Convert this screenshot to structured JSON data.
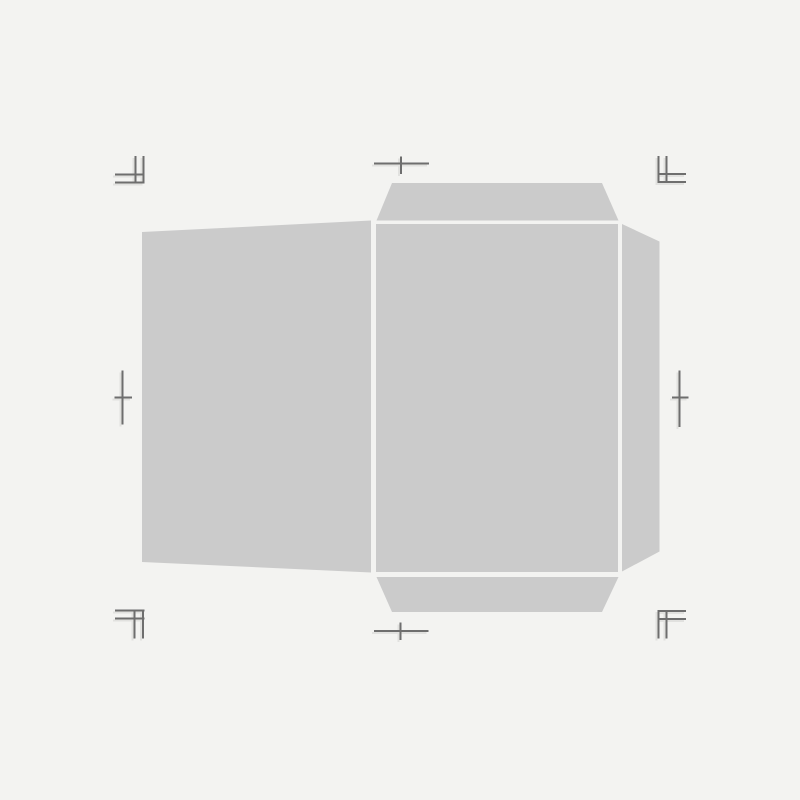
{
  "canvas": {
    "width": 800,
    "height": 800,
    "background": "#f3f3f1"
  },
  "template": {
    "kind": "envelope-dieline-template",
    "panel_fill": "#cbcbcb",
    "panels": {
      "left_panel": {
        "points": "142,232 371,220.5 371,572.5 142,562"
      },
      "center_panel": {
        "points": "376,224 618,224 618,572 376,572"
      },
      "top_flap": {
        "points": "392,183 602,183 618.5,220.5 376.5,220.5"
      },
      "bottom_flap": {
        "points": "376.5,577 618.5,577 602,612 392,612"
      },
      "right_flap": {
        "points": "622,224 659.5,241.5 659.5,551.5 622,571.5"
      }
    },
    "marks": {
      "color": "#6e6e6e",
      "shadow_color": "#e1e1df",
      "corner_top_left": {
        "d": "M 135.5 156 L 135.5 183.5 M 143.5 156 L 143.5 183.5 M 115 174.5 L 144.5 174.5 M 115 182.5 L 144.5 182.5"
      },
      "corner_top_right": {
        "d": "M 658.5 156 L 658.5 183 M 666.5 156 L 666.5 183 M 657.5 174 L 686 174 M 657.5 182 L 686 182"
      },
      "corner_bottom_left": {
        "d": "M 115 610.5 L 144.5 610.5 M 115 618.5 L 144.5 618.5 M 134.5 610 L 134.5 638.5 M 143 610 L 143 638.5"
      },
      "corner_bottom_right": {
        "d": "M 657.5 611 L 686 611 M 657.5 619 L 686 619 M 658.5 610.5 L 658.5 638.5 M 666.5 610.5 L 666.5 638.5"
      },
      "cross_top": {
        "d": "M 374 163.5 L 429 163.5 M 401 156.5 L 401 174"
      },
      "cross_bottom": {
        "d": "M 374 631 L 428.5 631 M 400.5 622.5 L 400.5 640"
      },
      "cross_left": {
        "d": "M 122.5 370.5 L 122.5 424.5 M 114.5 397.5 L 132 397.5"
      },
      "cross_right": {
        "d": "M 679.5 370.5 L 679.5 427 M 672 397.5 L 688.5 397.5"
      }
    }
  }
}
